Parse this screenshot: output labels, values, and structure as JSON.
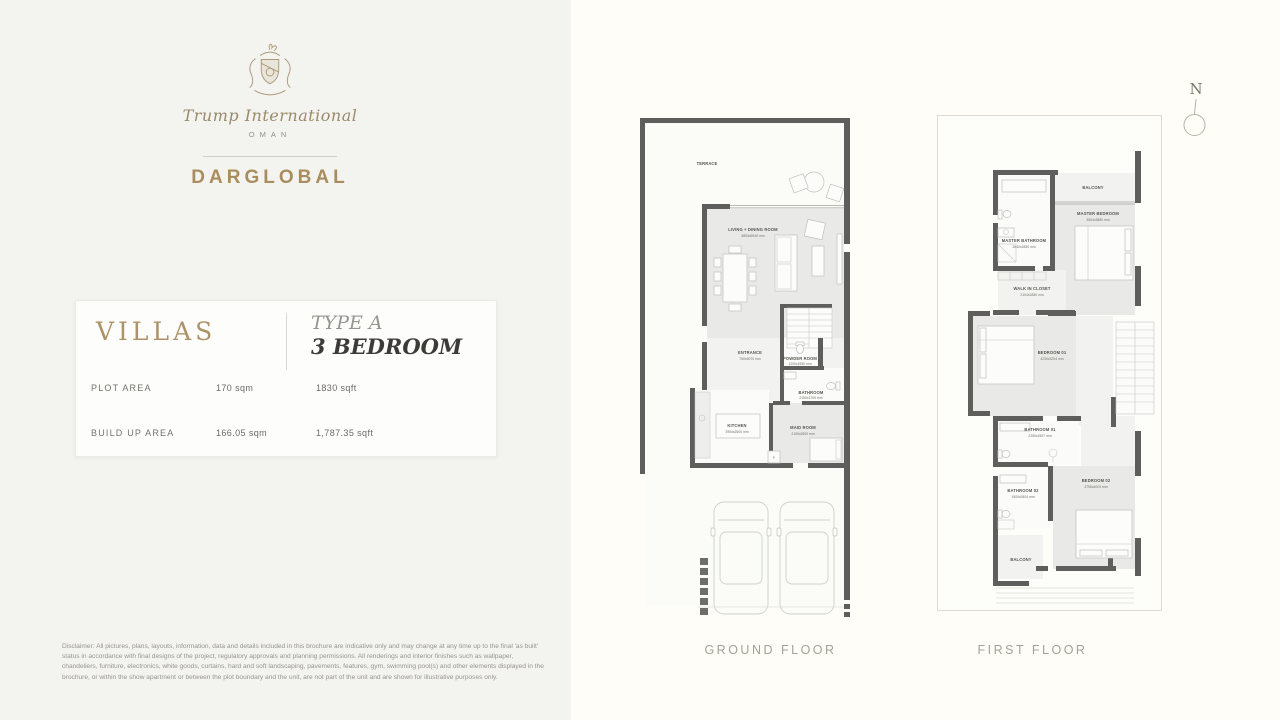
{
  "brand": {
    "name": "Trump International",
    "location": "OMAN",
    "developer": "DARGLOBAL"
  },
  "info_card": {
    "category": "VILLAS",
    "type_label": "TYPE A",
    "type_bedrooms": "3 BEDROOM",
    "rows": [
      {
        "label": "PLOT AREA",
        "metric": "170 sqm",
        "imperial": "1830 sqft"
      },
      {
        "label": "BUILD UP AREA",
        "metric": "166.05 sqm",
        "imperial": "1,787.35 sqft"
      }
    ]
  },
  "disclaimer": "Disclaimer: All pictures, plans, layouts, information, data and details included in this brochure are indicative only and may change at any time up to the final 'as built' status in accordance with final designs of the project, regulatory approvals and planning permissions. All renderings and interior finishes such as wallpaper, chandeliers, furniture, electronics, white goods, curtains, hard and soft landscaping, pavements, features, gym, swimming pool(s) and other elements displayed in the brochure, or within the show apartment or between the plot boundary and the unit, are not part of the unit and are shown for illustrative purposes only.",
  "compass": {
    "north_label": "N"
  },
  "ground_floor": {
    "title": "GROUND FLOOR",
    "rooms": {
      "terrace": "TERRACE",
      "living_name": "LIVING + DINING ROOM",
      "living_dim": "5853x5940 mm",
      "entrance_name": "ENTRANCE",
      "entrance_dim": "750x5070 mm",
      "powder_name": "POWDER ROOM",
      "powder_dim": "1200x1550 mm",
      "bath_name": "BATHROOM",
      "bath_dim": "2150x1750 mm",
      "kitchen_name": "KITCHEN",
      "kitchen_dim": "3954x2500 mm",
      "maid_name": "MAID ROOM",
      "maid_dim": "2150x2500 mm",
      "fridge": "F"
    }
  },
  "first_floor": {
    "title": "FIRST FLOOR",
    "rooms": {
      "balcony_top": "BALCONY",
      "master_bed_name": "MASTER BEDROOM",
      "master_bed_dim": "3554x3880 mm",
      "master_bath_name": "MASTER BATHROOM",
      "master_bath_dim": "2640x1880 mm",
      "closet_name": "WALK IN CLOSET",
      "closet_dim": "2104x1880 mm",
      "bed1_name": "BEDROOM 01",
      "bed1_dim": "4230x3254 mm",
      "bath1_name": "BATHROOM 01",
      "bath1_dim": "2250x1557 mm",
      "bath2_name": "BATHROOM 02",
      "bath2_dim": "1900x2604 mm",
      "bed2_name": "BEDROOM 02",
      "bed2_dim": "3755x4004 mm",
      "balcony_bottom": "BALCONY"
    }
  }
}
